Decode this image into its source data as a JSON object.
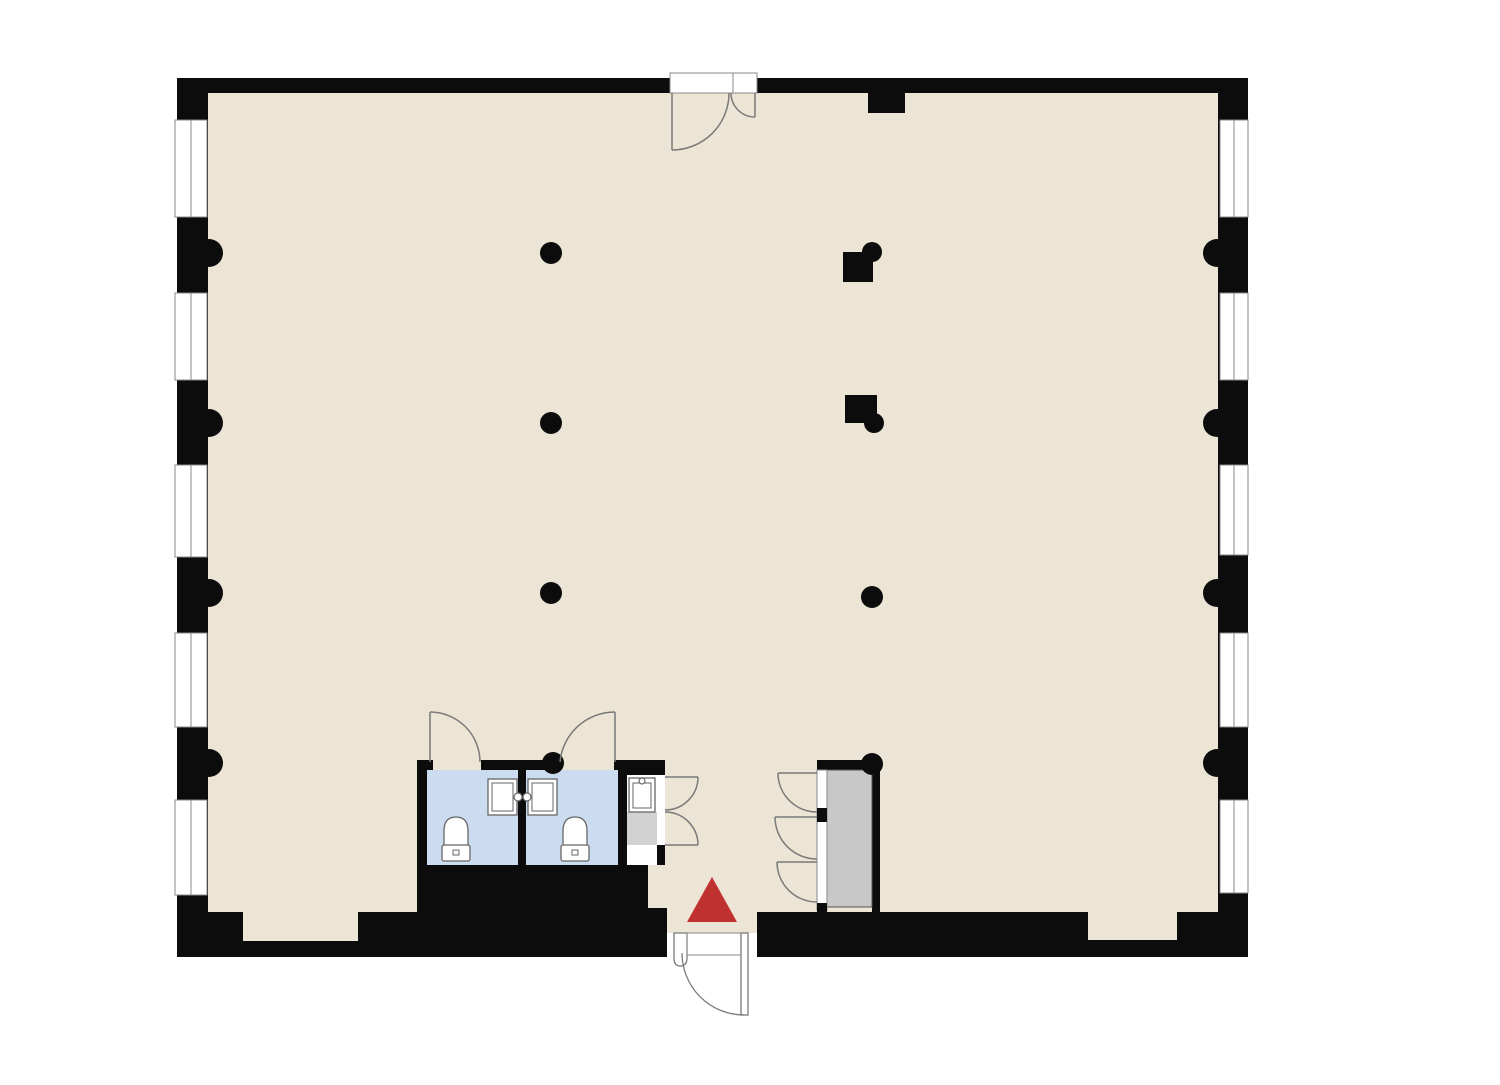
{
  "plan": {
    "width": 1500,
    "height": 1085,
    "colors": {
      "wall": "#0c0c0c",
      "floor": "#ece4d4",
      "white": "#ffffff",
      "bath": "#cbdcf1",
      "closet": "#c8c8c8",
      "grayband": "#d2d2d2",
      "frame": "#888888",
      "line": "#7a7a7a",
      "fixture": "#666666",
      "outline": "#555555",
      "accent": "#c03230",
      "bg": "#ffffff"
    },
    "shapes": [
      {
        "name": "building-shell",
        "kind": "rect",
        "x": 177,
        "y": 78,
        "w": 1071,
        "h": 879,
        "fill": "wall"
      },
      {
        "name": "main-floor",
        "kind": "path",
        "d": "M208,93 L1218,93 L1218,912 L1177,912 L1177,940 L1088,940 L1088,912 L757,912 L757,933 L667,933 L667,912 L358,912 L358,941 L243,941 L243,912 L208,912 Z",
        "fill": "floor"
      },
      {
        "name": "window-left-1",
        "kind": "rect",
        "x": 175,
        "y": 120,
        "w": 32,
        "h": 97,
        "fill": "white",
        "stroke": "frame",
        "sw": 1
      },
      {
        "name": "window-left-1-mullion",
        "kind": "line",
        "x1": 191,
        "y1": 120,
        "x2": 191,
        "y2": 217,
        "stroke": "frame",
        "sw": 1
      },
      {
        "name": "window-left-2",
        "kind": "rect",
        "x": 175,
        "y": 293,
        "w": 32,
        "h": 87,
        "fill": "white",
        "stroke": "frame",
        "sw": 1
      },
      {
        "name": "window-left-2-mullion",
        "kind": "line",
        "x1": 191,
        "y1": 293,
        "x2": 191,
        "y2": 380,
        "stroke": "frame",
        "sw": 1
      },
      {
        "name": "window-left-3",
        "kind": "rect",
        "x": 175,
        "y": 465,
        "w": 32,
        "h": 92,
        "fill": "white",
        "stroke": "frame",
        "sw": 1
      },
      {
        "name": "window-left-3-mullion",
        "kind": "line",
        "x1": 191,
        "y1": 465,
        "x2": 191,
        "y2": 557,
        "stroke": "frame",
        "sw": 1
      },
      {
        "name": "window-left-4",
        "kind": "rect",
        "x": 175,
        "y": 633,
        "w": 32,
        "h": 94,
        "fill": "white",
        "stroke": "frame",
        "sw": 1
      },
      {
        "name": "window-left-4-mullion",
        "kind": "line",
        "x1": 191,
        "y1": 633,
        "x2": 191,
        "y2": 727,
        "stroke": "frame",
        "sw": 1
      },
      {
        "name": "window-left-5",
        "kind": "rect",
        "x": 175,
        "y": 800,
        "w": 32,
        "h": 95,
        "fill": "white",
        "stroke": "frame",
        "sw": 1
      },
      {
        "name": "window-left-5-mullion",
        "kind": "line",
        "x1": 191,
        "y1": 800,
        "x2": 191,
        "y2": 895,
        "stroke": "frame",
        "sw": 1
      },
      {
        "name": "window-right-1",
        "kind": "rect",
        "x": 1220,
        "y": 120,
        "w": 28,
        "h": 97,
        "fill": "white",
        "stroke": "frame",
        "sw": 1
      },
      {
        "name": "window-right-1-mullion",
        "kind": "line",
        "x1": 1234,
        "y1": 120,
        "x2": 1234,
        "y2": 217,
        "stroke": "frame",
        "sw": 1
      },
      {
        "name": "window-right-2",
        "kind": "rect",
        "x": 1220,
        "y": 293,
        "w": 28,
        "h": 87,
        "fill": "white",
        "stroke": "frame",
        "sw": 1
      },
      {
        "name": "window-right-2-mullion",
        "kind": "line",
        "x1": 1234,
        "y1": 293,
        "x2": 1234,
        "y2": 380,
        "stroke": "frame",
        "sw": 1
      },
      {
        "name": "window-right-3",
        "kind": "rect",
        "x": 1220,
        "y": 465,
        "w": 28,
        "h": 90,
        "fill": "white",
        "stroke": "frame",
        "sw": 1
      },
      {
        "name": "window-right-3-mullion",
        "kind": "line",
        "x1": 1234,
        "y1": 465,
        "x2": 1234,
        "y2": 555,
        "stroke": "frame",
        "sw": 1
      },
      {
        "name": "window-right-4",
        "kind": "rect",
        "x": 1220,
        "y": 633,
        "w": 28,
        "h": 94,
        "fill": "white",
        "stroke": "frame",
        "sw": 1
      },
      {
        "name": "window-right-4-mullion",
        "kind": "line",
        "x1": 1234,
        "y1": 633,
        "x2": 1234,
        "y2": 727,
        "stroke": "frame",
        "sw": 1
      },
      {
        "name": "window-right-5",
        "kind": "rect",
        "x": 1220,
        "y": 800,
        "w": 28,
        "h": 93,
        "fill": "white",
        "stroke": "frame",
        "sw": 1
      },
      {
        "name": "window-right-5-mullion",
        "kind": "line",
        "x1": 1234,
        "y1": 800,
        "x2": 1234,
        "y2": 893,
        "stroke": "frame",
        "sw": 1
      },
      {
        "name": "wall-pilaster-left-1",
        "kind": "circle",
        "cx": 209,
        "cy": 253,
        "r": 14,
        "fill": "wall"
      },
      {
        "name": "wall-pilaster-left-2",
        "kind": "circle",
        "cx": 209,
        "cy": 423,
        "r": 14,
        "fill": "wall"
      },
      {
        "name": "wall-pilaster-left-3",
        "kind": "circle",
        "cx": 209,
        "cy": 593,
        "r": 14,
        "fill": "wall"
      },
      {
        "name": "wall-pilaster-left-4",
        "kind": "circle",
        "cx": 209,
        "cy": 763,
        "r": 14,
        "fill": "wall"
      },
      {
        "name": "wall-pilaster-right-1",
        "kind": "circle",
        "cx": 1217,
        "cy": 253,
        "r": 14,
        "fill": "wall"
      },
      {
        "name": "wall-pilaster-right-2",
        "kind": "circle",
        "cx": 1217,
        "cy": 423,
        "r": 14,
        "fill": "wall"
      },
      {
        "name": "wall-pilaster-right-3",
        "kind": "circle",
        "cx": 1217,
        "cy": 593,
        "r": 14,
        "fill": "wall"
      },
      {
        "name": "wall-pilaster-right-4",
        "kind": "circle",
        "cx": 1217,
        "cy": 763,
        "r": 14,
        "fill": "wall"
      },
      {
        "name": "top-wall-pier",
        "kind": "rect",
        "x": 868,
        "y": 93,
        "w": 37,
        "h": 20,
        "fill": "wall"
      },
      {
        "name": "top-door-frame",
        "kind": "rect",
        "x": 670,
        "y": 73,
        "w": 87,
        "h": 20,
        "fill": "white",
        "stroke": "frame",
        "sw": 1
      },
      {
        "name": "top-door-frame-divider",
        "kind": "line",
        "x1": 733,
        "y1": 73,
        "x2": 733,
        "y2": 93,
        "stroke": "frame",
        "sw": 1
      },
      {
        "name": "top-door-leaf-main",
        "kind": "line",
        "x1": 672,
        "y1": 93,
        "x2": 672,
        "y2": 150,
        "stroke": "line",
        "sw": 1.5
      },
      {
        "name": "top-door-swing-main",
        "kind": "path",
        "d": "M672,150 A57,57 0 0 0 729,93",
        "stroke": "line",
        "sw": 1.5
      },
      {
        "name": "top-door-leaf-small",
        "kind": "line",
        "x1": 755,
        "y1": 93,
        "x2": 755,
        "y2": 117,
        "stroke": "line",
        "sw": 1.5
      },
      {
        "name": "top-door-swing-small",
        "kind": "path",
        "d": "M755,117 A24,24 0 0 1 731,93",
        "stroke": "line",
        "sw": 1.5
      },
      {
        "name": "column-1",
        "kind": "circle",
        "cx": 551,
        "cy": 253,
        "r": 11,
        "fill": "wall"
      },
      {
        "name": "column-2",
        "kind": "circle",
        "cx": 551,
        "cy": 423,
        "r": 11,
        "fill": "wall"
      },
      {
        "name": "column-3",
        "kind": "circle",
        "cx": 551,
        "cy": 593,
        "r": 11,
        "fill": "wall"
      },
      {
        "name": "column-4",
        "kind": "circle",
        "cx": 872,
        "cy": 597,
        "r": 11,
        "fill": "wall"
      },
      {
        "name": "column-duct-a",
        "kind": "rect",
        "x": 843,
        "y": 252,
        "w": 30,
        "h": 30,
        "fill": "wall"
      },
      {
        "name": "column-duct-a-column",
        "kind": "circle",
        "cx": 872,
        "cy": 252,
        "r": 10,
        "fill": "wall"
      },
      {
        "name": "column-duct-b",
        "kind": "rect",
        "x": 845,
        "y": 395,
        "w": 32,
        "h": 28,
        "fill": "wall"
      },
      {
        "name": "column-duct-b-column",
        "kind": "circle",
        "cx": 874,
        "cy": 423,
        "r": 10,
        "fill": "wall"
      },
      {
        "name": "wc-block-left-wall",
        "kind": "rect",
        "x": 417,
        "y": 760,
        "w": 10,
        "h": 105,
        "fill": "wall"
      },
      {
        "name": "wc-block-top-wall",
        "kind": "rect",
        "x": 417,
        "y": 760,
        "w": 248,
        "h": 10,
        "fill": "wall"
      },
      {
        "name": "wc-block-mid-wall",
        "kind": "rect",
        "x": 518,
        "y": 770,
        "w": 8,
        "h": 95,
        "fill": "wall"
      },
      {
        "name": "wc-block-wall-2",
        "kind": "rect",
        "x": 618,
        "y": 760,
        "w": 9,
        "h": 105,
        "fill": "wall"
      },
      {
        "name": "wc-block-wall-3",
        "kind": "rect",
        "x": 627,
        "y": 770,
        "w": 38,
        "h": 5,
        "fill": "wall"
      },
      {
        "name": "wc-block-wall-4",
        "kind": "rect",
        "x": 657,
        "y": 845,
        "w": 8,
        "h": 20,
        "fill": "wall"
      },
      {
        "name": "wc-block-service-mass",
        "kind": "rect",
        "x": 417,
        "y": 865,
        "w": 231,
        "h": 92,
        "fill": "wall"
      },
      {
        "name": "wc-block-service-mass-2",
        "kind": "rect",
        "x": 648,
        "y": 908,
        "w": 19,
        "h": 25,
        "fill": "wall"
      },
      {
        "name": "wc-door-opening-left",
        "kind": "rect",
        "x": 433,
        "y": 760,
        "w": 48,
        "h": 10,
        "fill": "floor"
      },
      {
        "name": "wc-door-opening-right",
        "kind": "rect",
        "x": 560,
        "y": 760,
        "w": 54,
        "h": 10,
        "fill": "floor"
      },
      {
        "name": "utility-door-opening",
        "kind": "rect",
        "x": 657,
        "y": 775,
        "w": 8,
        "h": 70,
        "fill": "white"
      },
      {
        "name": "wc-room-left-floor",
        "kind": "rect",
        "x": 427,
        "y": 770,
        "w": 91,
        "h": 95,
        "fill": "bath"
      },
      {
        "name": "wc-room-right-floor",
        "kind": "rect",
        "x": 526,
        "y": 770,
        "w": 92,
        "h": 95,
        "fill": "bath"
      },
      {
        "name": "utility-room-floor",
        "kind": "rect",
        "x": 627,
        "y": 775,
        "w": 30,
        "h": 90,
        "fill": "white"
      },
      {
        "name": "utility-room-mat",
        "kind": "rect",
        "x": 627,
        "y": 812,
        "w": 30,
        "h": 33,
        "fill": "grayband"
      },
      {
        "name": "column-5",
        "kind": "circle",
        "cx": 553,
        "cy": 763,
        "r": 11,
        "fill": "wall"
      },
      {
        "name": "wc-left-door-leaf",
        "kind": "line",
        "x1": 430,
        "y1": 762,
        "x2": 430,
        "y2": 712,
        "stroke": "line",
        "sw": 1.5
      },
      {
        "name": "wc-left-door-swing",
        "kind": "path",
        "d": "M430,712 A50,50 0 0 1 480,762",
        "stroke": "line",
        "sw": 1.5
      },
      {
        "name": "wc-right-door-leaf",
        "kind": "line",
        "x1": 615,
        "y1": 762,
        "x2": 615,
        "y2": 712,
        "stroke": "line",
        "sw": 1.5
      },
      {
        "name": "wc-right-door-swing",
        "kind": "path",
        "d": "M615,712 A55,55 0 0 0 560,762",
        "stroke": "line",
        "sw": 1.5
      },
      {
        "name": "utility-door-leaf-top",
        "kind": "line",
        "x1": 665,
        "y1": 777,
        "x2": 698,
        "y2": 777,
        "stroke": "line",
        "sw": 1.5
      },
      {
        "name": "utility-door-swing-top",
        "kind": "path",
        "d": "M698,777 A33,33 0 0 1 665,810",
        "stroke": "line",
        "sw": 1.5
      },
      {
        "name": "utility-door-leaf-bottom",
        "kind": "line",
        "x1": 665,
        "y1": 845,
        "x2": 698,
        "y2": 845,
        "stroke": "line",
        "sw": 1.5
      },
      {
        "name": "utility-door-swing-bottom",
        "kind": "path",
        "d": "M698,845 A33,33 0 0 0 665,812",
        "stroke": "line",
        "sw": 1.5
      },
      {
        "name": "sink-left",
        "kind": "rect",
        "x": 488,
        "y": 779,
        "w": 29,
        "h": 36,
        "fill": "white",
        "stroke": "fixture",
        "sw": 1.3
      },
      {
        "name": "sink-left-basin",
        "kind": "rect",
        "x": 492,
        "y": 783,
        "w": 21,
        "h": 28,
        "fill": "white",
        "stroke": "fixture",
        "sw": 1
      },
      {
        "name": "sink-left-faucet",
        "kind": "circle",
        "cx": 518,
        "cy": 797,
        "r": 4,
        "fill": "white",
        "stroke": "fixture",
        "sw": 1.2
      },
      {
        "name": "sink-right",
        "kind": "rect",
        "x": 528,
        "y": 779,
        "w": 29,
        "h": 36,
        "fill": "white",
        "stroke": "fixture",
        "sw": 1.3
      },
      {
        "name": "sink-right-basin",
        "kind": "rect",
        "x": 532,
        "y": 783,
        "w": 21,
        "h": 28,
        "fill": "white",
        "stroke": "fixture",
        "sw": 1
      },
      {
        "name": "sink-right-faucet",
        "kind": "circle",
        "cx": 527,
        "cy": 797,
        "r": 4,
        "fill": "white",
        "stroke": "fixture",
        "sw": 1.2
      },
      {
        "name": "sink-utility",
        "kind": "rect",
        "x": 629,
        "y": 778,
        "w": 26,
        "h": 34,
        "fill": "white",
        "stroke": "fixture",
        "sw": 1.3
      },
      {
        "name": "sink-utility-basin",
        "kind": "rect",
        "x": 633,
        "y": 783,
        "w": 18,
        "h": 25,
        "fill": "white",
        "stroke": "fixture",
        "sw": 1
      },
      {
        "name": "sink-utility-faucet",
        "kind": "circle",
        "cx": 642,
        "cy": 781,
        "r": 3,
        "fill": "white",
        "stroke": "fixture",
        "sw": 1.2
      },
      {
        "name": "toilet-left-bowl",
        "kind": "path",
        "d": "M444,849 L444,831 Q444,817 456,817 Q468,817 468,831 L468,849 Z",
        "fill": "white",
        "stroke": "fixture",
        "sw": 1.3
      },
      {
        "name": "toilet-left-tank",
        "kind": "rect",
        "x": 442,
        "y": 845,
        "w": 28,
        "h": 16,
        "rx": 2,
        "fill": "white",
        "stroke": "fixture",
        "sw": 1.3
      },
      {
        "name": "toilet-left-button",
        "kind": "rect",
        "x": 453,
        "y": 850,
        "w": 6,
        "h": 5,
        "fill": "white",
        "stroke": "fixture",
        "sw": 1
      },
      {
        "name": "toilet-right-bowl",
        "kind": "path",
        "d": "M563,849 L563,831 Q563,817 575,817 Q587,817 587,831 L587,849 Z",
        "fill": "white",
        "stroke": "fixture",
        "sw": 1.3
      },
      {
        "name": "toilet-right-tank",
        "kind": "rect",
        "x": 561,
        "y": 845,
        "w": 28,
        "h": 16,
        "rx": 2,
        "fill": "white",
        "stroke": "fixture",
        "sw": 1.3
      },
      {
        "name": "toilet-right-button",
        "kind": "rect",
        "x": 572,
        "y": 850,
        "w": 6,
        "h": 5,
        "fill": "white",
        "stroke": "fixture",
        "sw": 1
      },
      {
        "name": "closet-top-wall",
        "kind": "rect",
        "x": 817,
        "y": 760,
        "w": 63,
        "h": 10,
        "fill": "wall"
      },
      {
        "name": "closet-right-wall",
        "kind": "rect",
        "x": 872,
        "y": 765,
        "w": 8,
        "h": 147,
        "fill": "wall"
      },
      {
        "name": "closet-body",
        "kind": "rect",
        "x": 827,
        "y": 770,
        "w": 45,
        "h": 137,
        "fill": "closet",
        "stroke": "outline",
        "sw": 1
      },
      {
        "name": "closet-door-track",
        "kind": "rect",
        "x": 817,
        "y": 770,
        "w": 10,
        "h": 140,
        "fill": "white",
        "stroke": "frame",
        "sw": 1
      },
      {
        "name": "closet-hinge-block-1",
        "kind": "rect",
        "x": 817,
        "y": 808,
        "w": 10,
        "h": 14,
        "fill": "wall"
      },
      {
        "name": "closet-hinge-block-2",
        "kind": "rect",
        "x": 817,
        "y": 903,
        "w": 10,
        "h": 9,
        "fill": "wall"
      },
      {
        "name": "column-6",
        "kind": "circle",
        "cx": 872,
        "cy": 764,
        "r": 11,
        "fill": "wall"
      },
      {
        "name": "closet-door-leaf-1",
        "kind": "line",
        "x1": 778,
        "y1": 773,
        "x2": 817,
        "y2": 773,
        "stroke": "line",
        "sw": 1.5
      },
      {
        "name": "closet-door-swing-1",
        "kind": "path",
        "d": "M778,773 A39,39 0 0 0 817,812",
        "stroke": "line",
        "sw": 1.5
      },
      {
        "name": "closet-door-leaf-2",
        "kind": "line",
        "x1": 775,
        "y1": 817,
        "x2": 817,
        "y2": 817,
        "stroke": "line",
        "sw": 1.5
      },
      {
        "name": "closet-door-swing-2",
        "kind": "path",
        "d": "M775,817 A42,42 0 0 0 817,859",
        "stroke": "line",
        "sw": 1.5
      },
      {
        "name": "closet-door-leaf-3",
        "kind": "line",
        "x1": 777,
        "y1": 862,
        "x2": 817,
        "y2": 862,
        "stroke": "line",
        "sw": 1.5
      },
      {
        "name": "closet-door-swing-3",
        "kind": "path",
        "d": "M777,862 A40,40 0 0 0 817,902",
        "stroke": "line",
        "sw": 1.5
      },
      {
        "name": "entrance-opening",
        "kind": "rect",
        "x": 667,
        "y": 933,
        "w": 90,
        "h": 24,
        "fill": "white"
      },
      {
        "name": "entrance-marker",
        "kind": "polygon",
        "points": "712,877 737,922 687,922",
        "fill": "accent"
      },
      {
        "name": "entrance-jamb",
        "kind": "path",
        "d": "M674,933 L687,933 L687,958 Q687,966 680,966 Q674,966 674,958 Z",
        "fill": "white",
        "stroke": "line",
        "sw": 1.3
      },
      {
        "name": "entrance-landing",
        "kind": "rect",
        "x": 687,
        "y": 933,
        "w": 57,
        "h": 22,
        "fill": "none",
        "stroke": "frame",
        "sw": 1
      },
      {
        "name": "entrance-door-leaf",
        "kind": "rect",
        "x": 741,
        "y": 933,
        "w": 7,
        "h": 82,
        "fill": "white",
        "stroke": "line",
        "sw": 1.3
      },
      {
        "name": "entrance-door-swing",
        "kind": "path",
        "d": "M744,1015 A62,62 0 0 1 682,953",
        "stroke": "line",
        "sw": 1.3
      }
    ]
  }
}
